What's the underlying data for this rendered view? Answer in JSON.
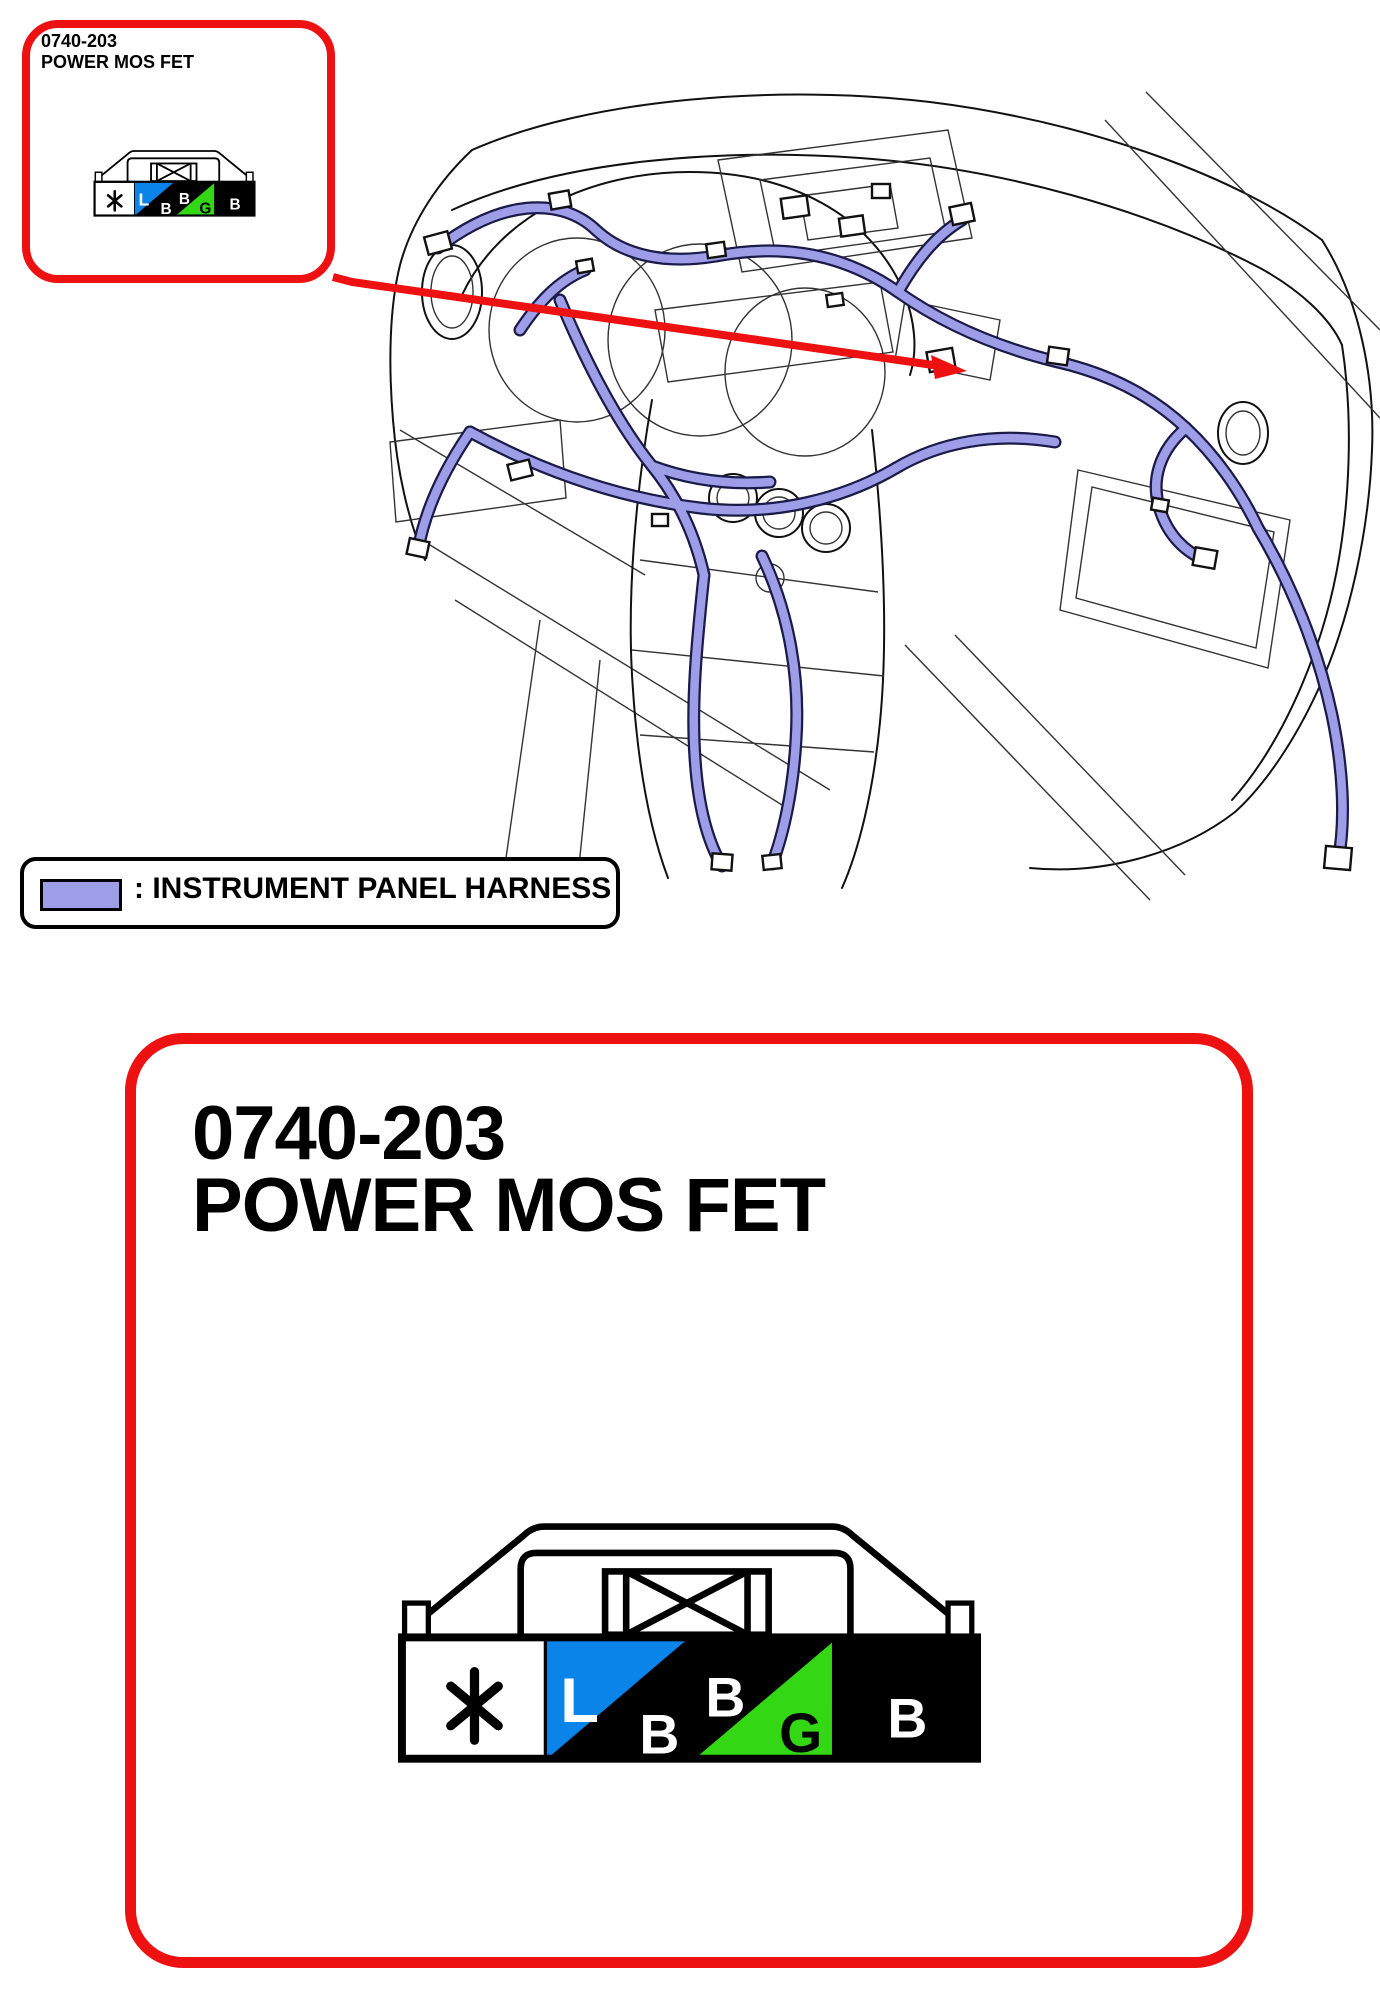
{
  "colors": {
    "red": "#ed1111",
    "purple": "#9d9de8",
    "outline": "#1b1b4a",
    "blue": "#0a84e8",
    "green": "#33d714",
    "ink": "#000000"
  },
  "callout": {
    "code": "0740-203",
    "name": "POWER MOS FET"
  },
  "legend": {
    "label": ": INSTRUMENT PANEL HARNESS"
  },
  "detail_panel": {
    "code": "0740-203",
    "name": "POWER MOS FET"
  },
  "connector_pins": {
    "pin1_symbol": "*",
    "pin2_top": "L",
    "pin2_bottom": "B",
    "pin3": "B",
    "pin4": "G",
    "pin5": "B"
  }
}
